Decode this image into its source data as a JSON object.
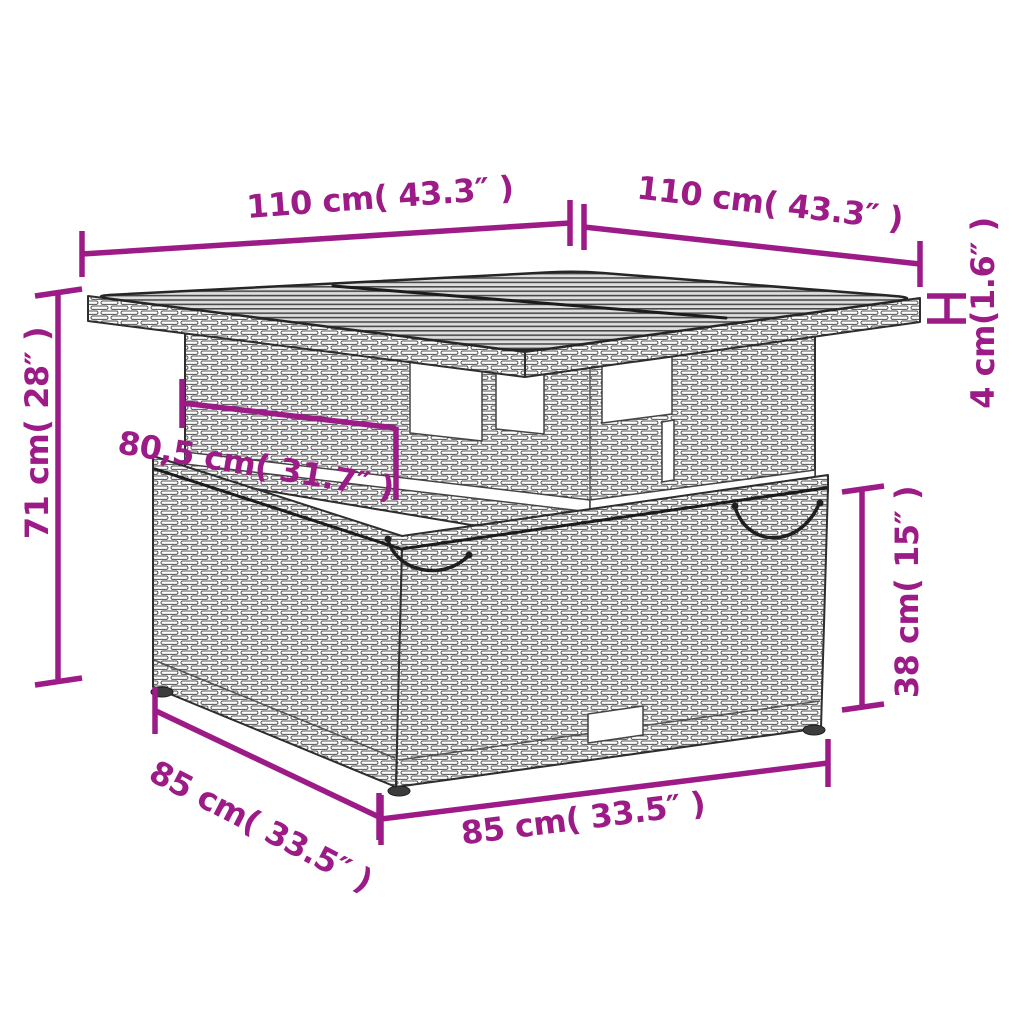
{
  "colors": {
    "accent": "#9C1B87",
    "line_art": "#2e2e2e",
    "background": "#ffffff"
  },
  "figure": {
    "subject": "poly-rattan garden table dimension diagram",
    "labels": {
      "tabletop_edge_left": "110 cm( 43.3″ )",
      "tabletop_edge_right": "110 cm( 43.3″ )",
      "tabletop_thickness": "4 cm(1.6″ )",
      "overall_height": "71 cm( 28″ )",
      "column_width": "80,5 cm( 31.7″ )",
      "base_height": "38 cm( 15″ )",
      "base_edge_left": "85 cm( 33.5″ )",
      "base_edge_front": "85 cm( 33.5″ )"
    },
    "values": {
      "tabletop_edge_cm": 110,
      "tabletop_edge_in": 43.3,
      "tabletop_thickness_cm": 4,
      "tabletop_thickness_in": 1.6,
      "overall_height_cm": 71,
      "overall_height_in": 28,
      "column_width_cm": "80,5",
      "column_width_in": 31.7,
      "base_height_cm": 38,
      "base_height_in": 15,
      "base_edge_cm": 85,
      "base_edge_in": 33.5
    }
  }
}
